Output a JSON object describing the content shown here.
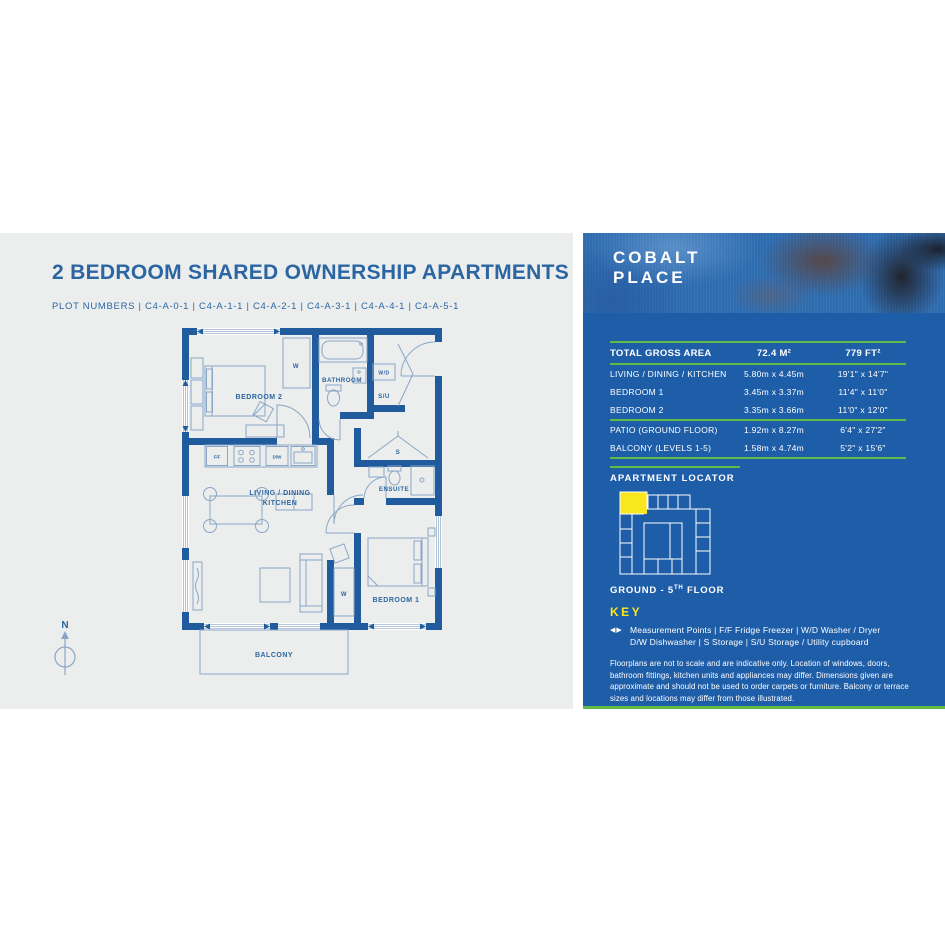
{
  "header": {
    "title": "2 BEDROOM SHARED OWNERSHIP APARTMENTS",
    "plot_numbers": "PLOT NUMBERS  |  C4-A-0-1  |  C4-A-1-1  |  C4-A-2-1  |  C4-A-3-1  |  C4-A-4-1  |  C4-A-5-1"
  },
  "floorplan": {
    "labels": {
      "bedroom2": "BEDROOM 2",
      "bathroom": "BATHROOM",
      "wardrobe": "W",
      "wd": "W/D",
      "su": "S/U",
      "storage": "S",
      "ensuite": "ENSUITE",
      "living_line1": "LIVING / DINING",
      "living_line2": "KITCHEN",
      "bedroom1": "BEDROOM 1",
      "wardrobe2": "W",
      "balcony": "BALCONY",
      "ff": "F/F",
      "dw": "D/W"
    },
    "compass": "N"
  },
  "panel": {
    "brand": {
      "line1": "COBALT",
      "line2": "PLACE"
    },
    "table": {
      "header": {
        "label": "TOTAL GROSS AREA",
        "metric": "72.4 M²",
        "imperial": "779 FT²"
      },
      "rows": [
        {
          "label": "LIVING / DINING / KITCHEN",
          "metric": "5.80m x 4.45m",
          "imperial": "19'1\" x 14'7\""
        },
        {
          "label": "BEDROOM 1",
          "metric": "3.45m x 3.37m",
          "imperial": "11'4\" x 11'0\""
        },
        {
          "label": "BEDROOM 2",
          "metric": "3.35m x 3.66m",
          "imperial": "11'0\" x 12'0\""
        },
        {
          "label": "PATIO (GROUND FLOOR)",
          "metric": "1.92m x 8.27m",
          "imperial": "6'4\" x 27'2\""
        },
        {
          "label": "BALCONY (LEVELS 1-5)",
          "metric": "1.58m x 4.74m",
          "imperial": "5'2\" x 15'6\""
        }
      ]
    },
    "locator": {
      "heading": "APARTMENT LOCATOR",
      "floor_prefix": "GROUND - 5",
      "floor_sup": "TH",
      "floor_suffix": " FLOOR"
    },
    "key": {
      "heading": "KEY",
      "measurement_icon": "◀▶",
      "line1": "Measurement Points  |  F/F Fridge Freezer  |  W/D Washer / Dryer",
      "line2": "D/W Dishwasher  |  S Storage  |  S/U Storage / Utility cupboard"
    },
    "disclaimer": "Floorplans are not to scale and are indicative only. Location of windows, doors, bathroom fittings, kitchen units and appliances may differ. Dimensions given are approximate and should not be used to order carpets or furniture. Balcony or terrace sizes and locations may differ from those illustrated."
  },
  "colors": {
    "panel_blue": "#1E5DA8",
    "accent_green": "#62BB46",
    "highlight_yellow": "#F8E71C",
    "plan_blue": "#1F5B9D",
    "text_blue": "#2B66A3",
    "background_gray": "#ECEEED"
  }
}
